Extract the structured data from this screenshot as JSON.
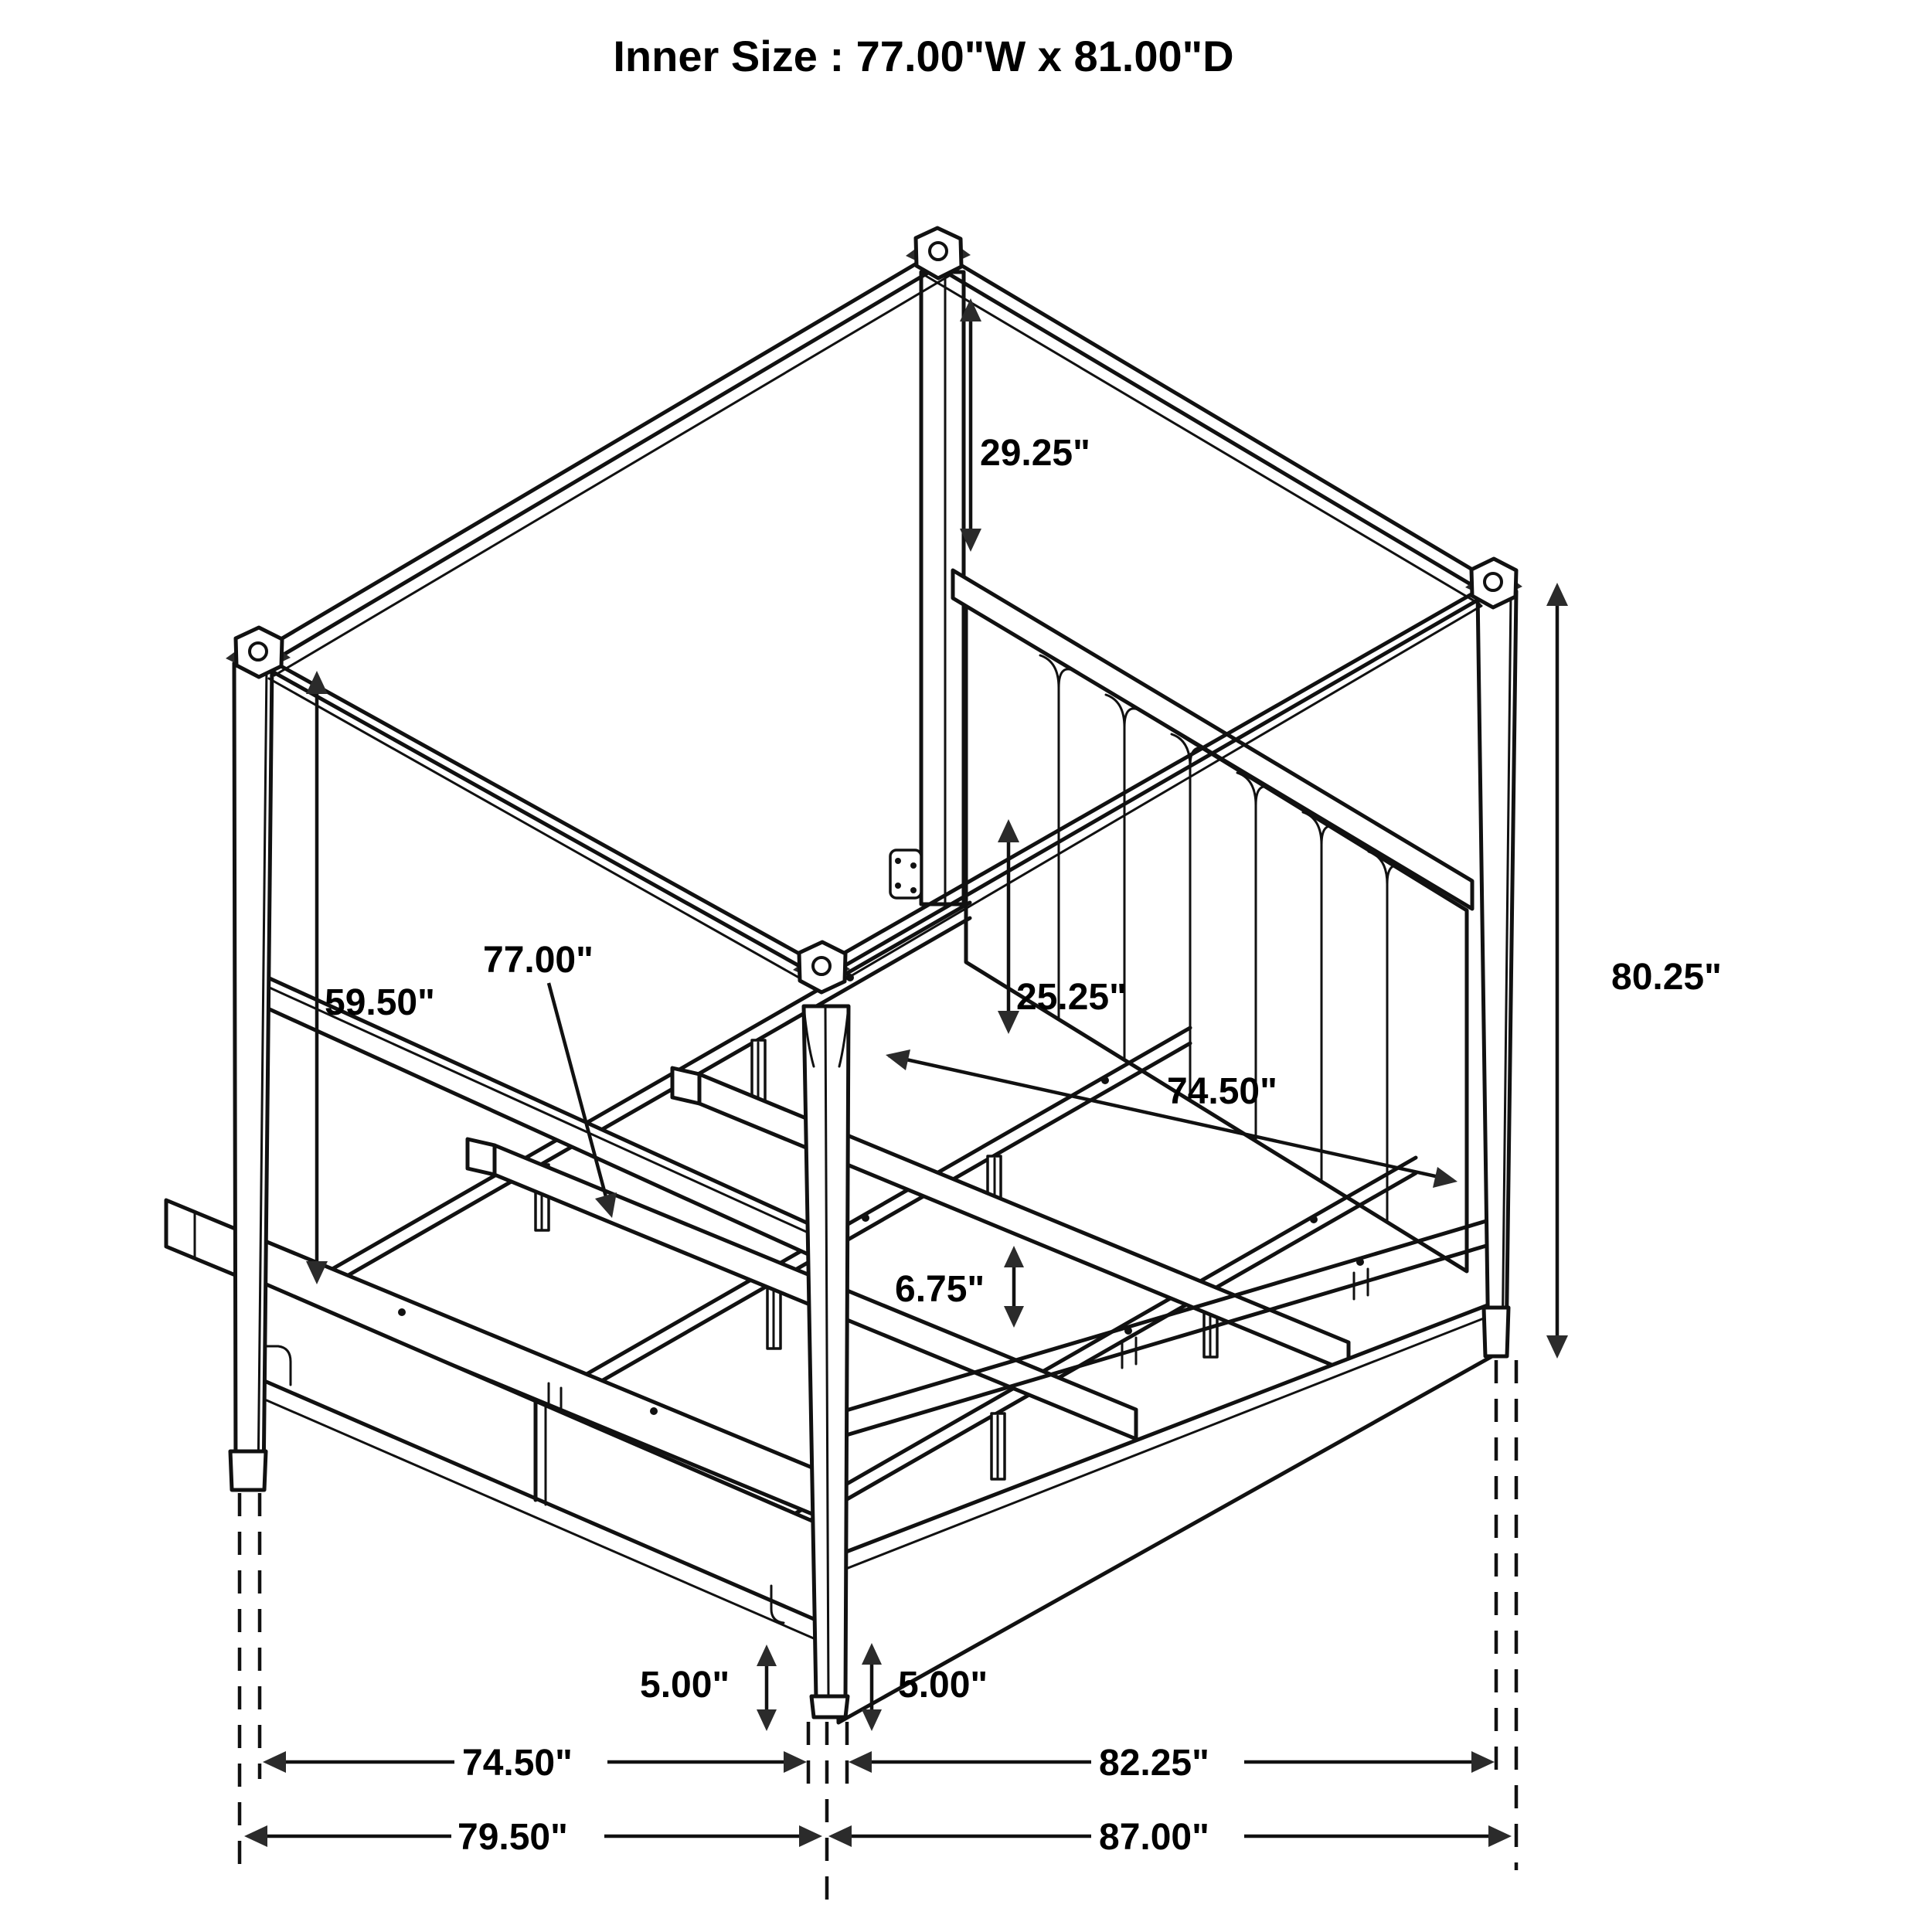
{
  "title": "Inner Size : 77.00\"W x 81.00\"D",
  "diagram": {
    "type": "furniture-dimension-drawing",
    "subject": "four-poster canopy storage bed, isometric line drawing",
    "labels": {
      "post_above_headboard": "29.25\"",
      "overall_height": "80.25\"",
      "canopy_to_rail": "59.50\"",
      "slat_length": "77.00\"",
      "rail_height": "25.25\"",
      "inner_width_mid": "74.50\"",
      "leg_height": "6.75\"",
      "left_post_width": "5.00\"",
      "near_post_width": "5.00\"",
      "inner_width_bottom": "74.50\"",
      "inner_depth_bottom": "82.25\"",
      "overall_width": "79.50\"",
      "overall_depth": "87.00\""
    }
  }
}
